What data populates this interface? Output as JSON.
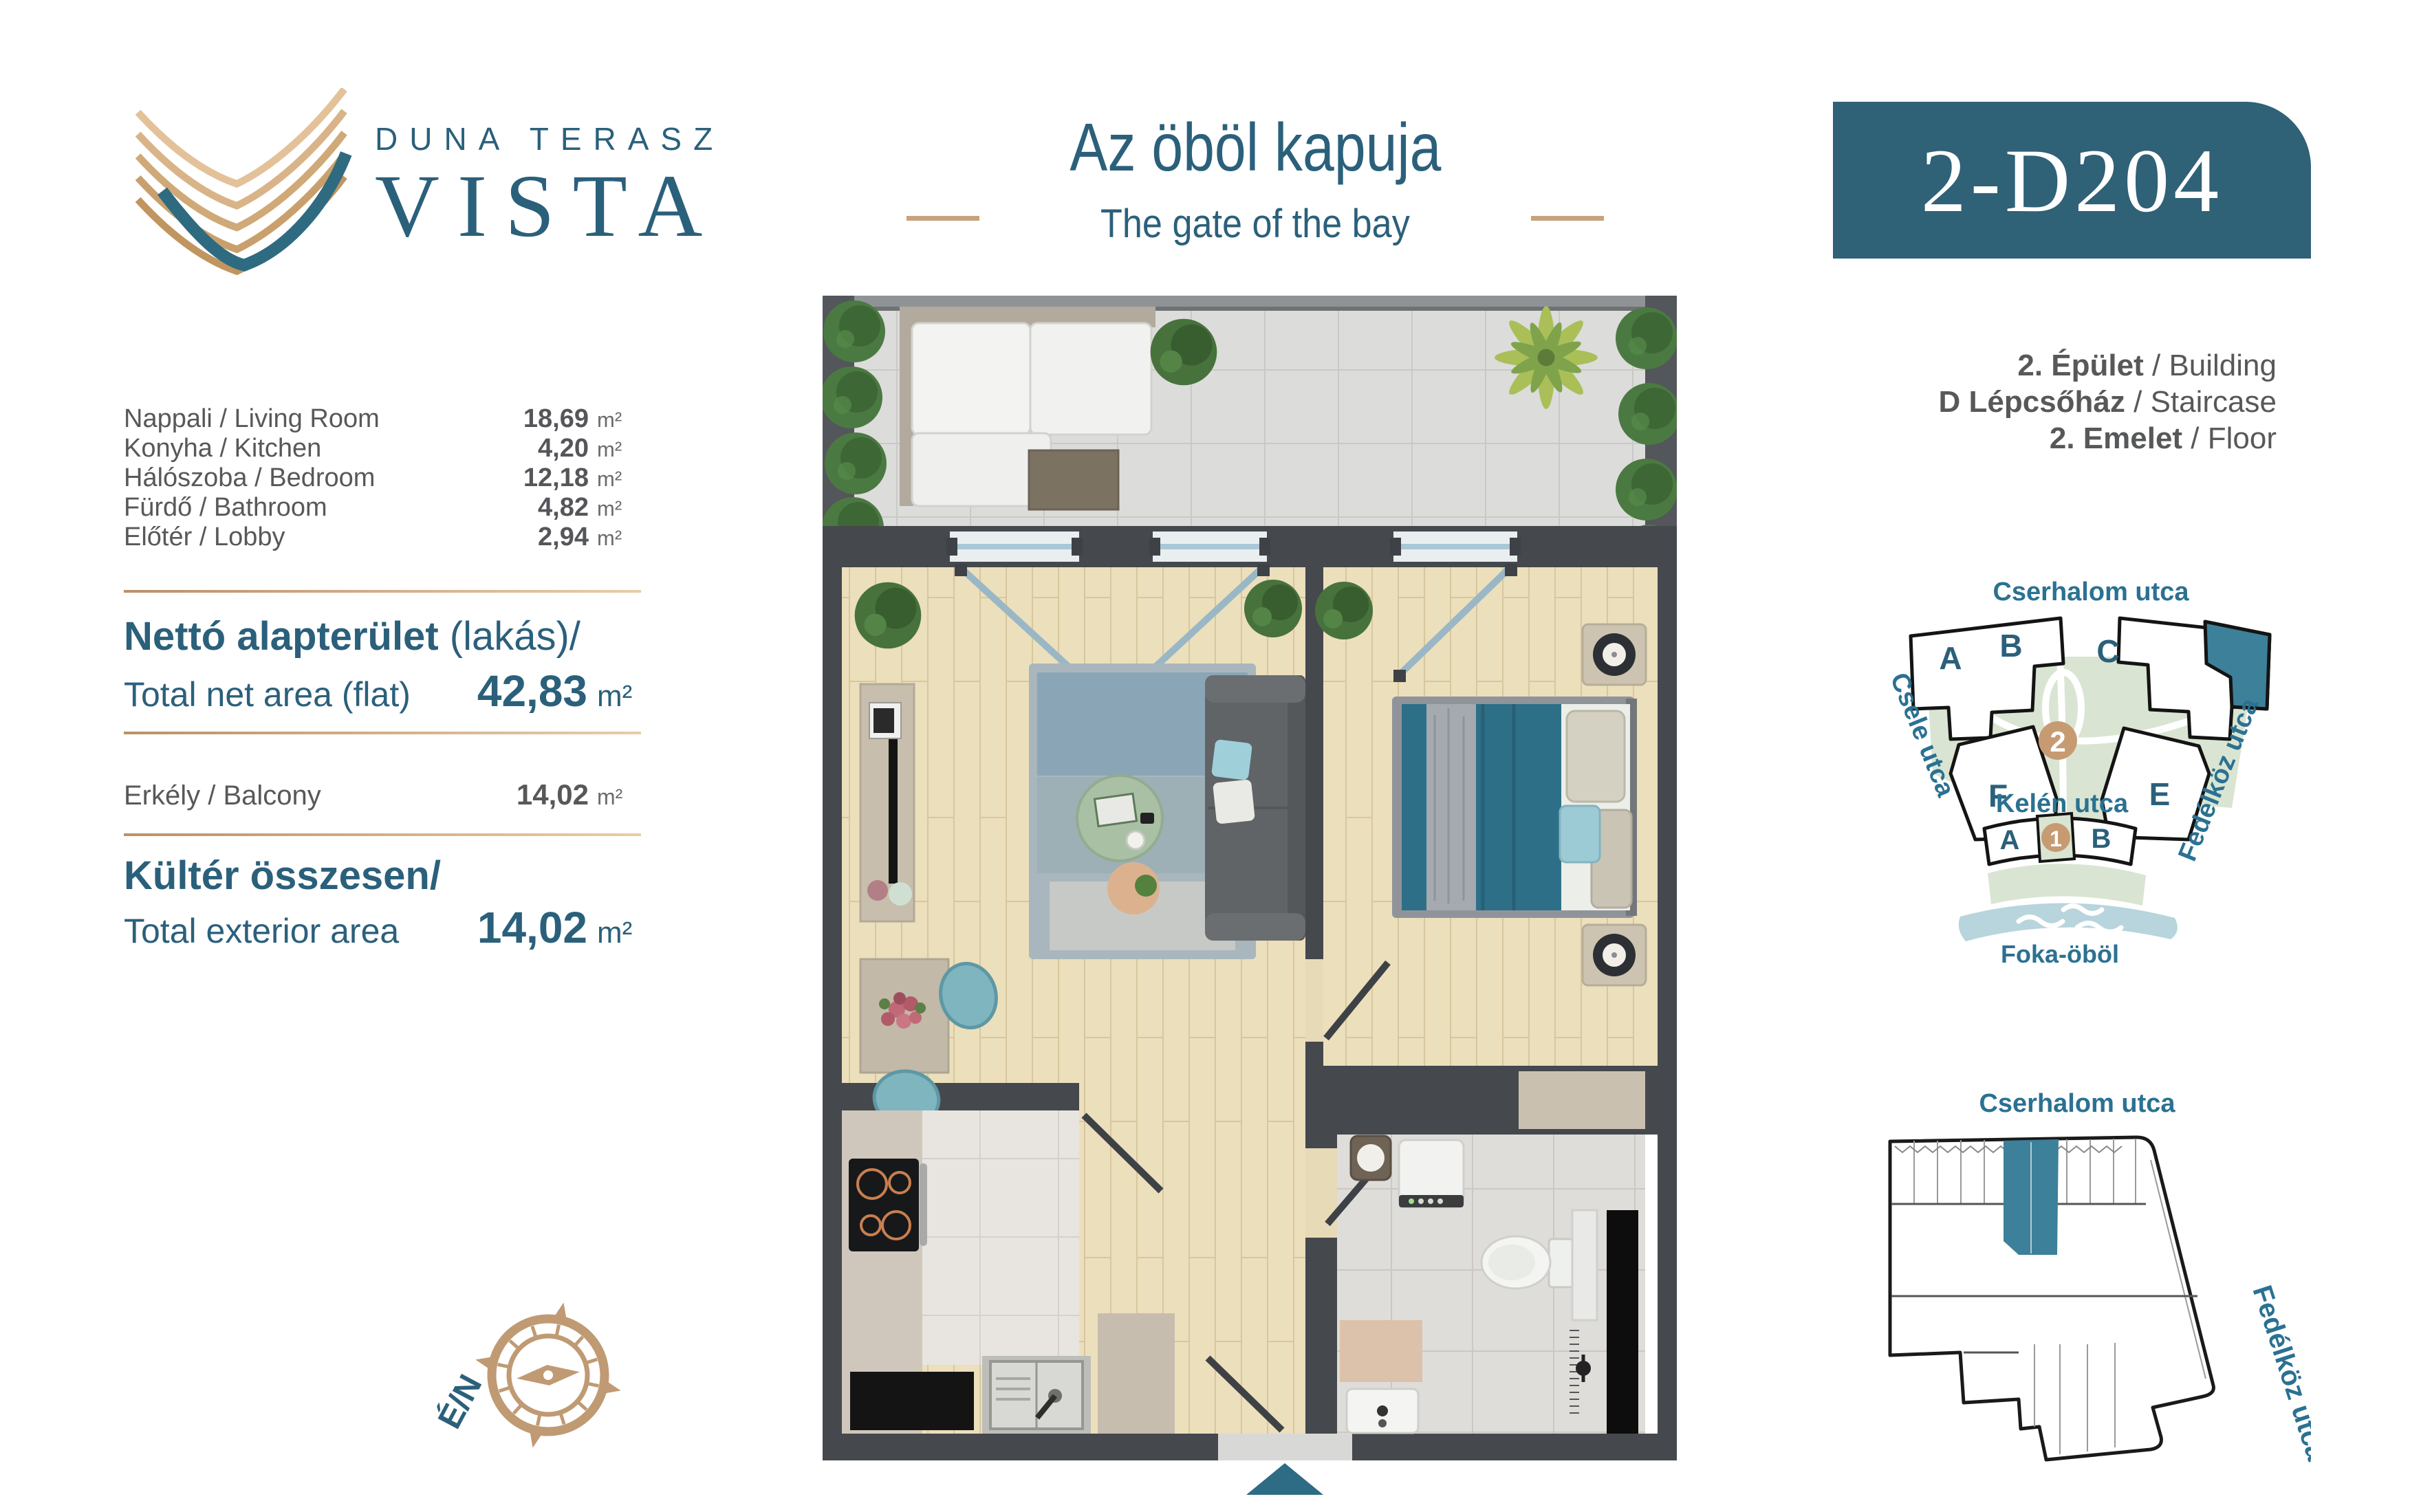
{
  "brand": {
    "line1": "DUNA TERASZ",
    "line2": "VISTA"
  },
  "header": {
    "title": "Az öböl kapuja",
    "subtitle": "The gate of the bay",
    "unit_code": "2-D204"
  },
  "area_table": {
    "rooms": [
      {
        "label": "Nappali / Living Room",
        "value": "18,69",
        "unit": "m²"
      },
      {
        "label": "Konyha / Kitchen",
        "value": "4,20",
        "unit": "m²"
      },
      {
        "label": "Hálószoba / Bedroom",
        "value": "12,18",
        "unit": "m²"
      },
      {
        "label": "Fürdő / Bathroom",
        "value": "4,82",
        "unit": "m²"
      },
      {
        "label": "Előtér / Lobby",
        "value": "2,94",
        "unit": "m²"
      }
    ]
  },
  "totals": {
    "net_title_bold": "Nettó alapterület",
    "net_title_light": " (lakás)/",
    "net_label_en": "Total net area (flat)",
    "net_value": "42,83",
    "net_unit": "m²",
    "balcony_label": "Erkély / Balcony",
    "balcony_value": "14,02",
    "balcony_unit": "m²",
    "ext_title": "Kültér összesen/",
    "ext_label_en": "Total exterior area",
    "ext_value": "14,02",
    "ext_unit": "m²"
  },
  "building_info": {
    "line1_hu": "2. Épület",
    "line1_en": " / Building",
    "line2_hu": "D Lépcsőház",
    "line2_en": " / Staircase",
    "line3_hu": "2. Emelet",
    "line3_en": " / Floor"
  },
  "site_map": {
    "street_top": "Cserhalom utca",
    "street_left": "Csele utca",
    "street_right": "Fedélköz utca",
    "street_bottom": "Kelén utca",
    "bay": "Foka-öböl",
    "blocks": {
      "a": "A",
      "b": "B",
      "c": "C",
      "d": "D",
      "e": "E",
      "f": "F",
      "phase2": "2",
      "lower_a": "A",
      "lower_1": "1",
      "lower_b": "B"
    }
  },
  "key_map": {
    "street_top": "Cserhalom utca",
    "street_right": "Fedélköz utca"
  },
  "compass": {
    "label": "É/N"
  },
  "colors": {
    "teal_text": "#2b607b",
    "teal_badge": "#2f6177",
    "teal_highlight": "#3d8099",
    "tan_accent": "#c7a27e",
    "compass_tan": "#bf9a73",
    "gray_text": "#57585a",
    "map_green": "#d9e5d2",
    "map_water": "#b8d4dc",
    "map_circle": "#c79b72",
    "floor_wood": "#ecdfbc",
    "wall_dark": "#45484c",
    "bed_teal": "#2e6f88",
    "entry_arrow": "#2e6b84"
  }
}
